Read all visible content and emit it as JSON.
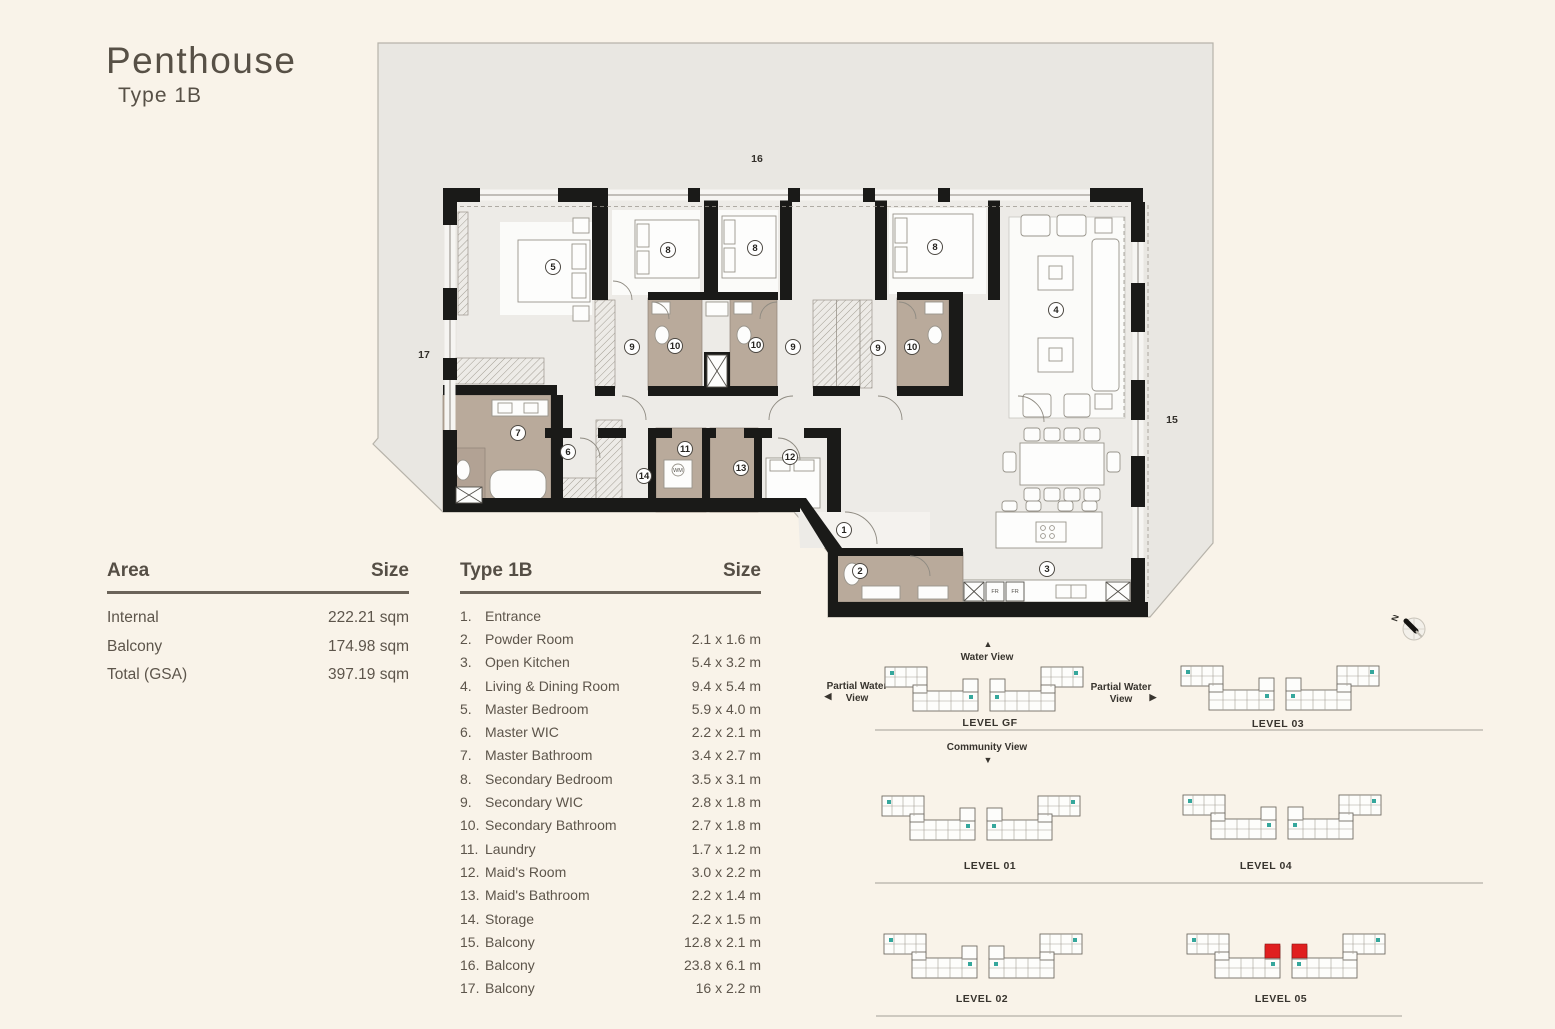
{
  "header": {
    "title": "Penthouse",
    "subtitle": "Type 1B"
  },
  "area_table": {
    "header": {
      "label": "Area",
      "size": "Size"
    },
    "rows": [
      {
        "label": "Internal",
        "value": "222.21 sqm"
      },
      {
        "label": "Balcony",
        "value": "174.98 sqm"
      },
      {
        "label": "Total (GSA)",
        "value": "397.19 sqm"
      }
    ]
  },
  "legend": {
    "header": {
      "label": "Type 1B",
      "size": "Size"
    },
    "rows": [
      {
        "num": "1.",
        "name": "Entrance",
        "size": ""
      },
      {
        "num": "2.",
        "name": "Powder Room",
        "size": "2.1 x 1.6 m"
      },
      {
        "num": "3.",
        "name": "Open Kitchen",
        "size": "5.4 x 3.2 m"
      },
      {
        "num": "4.",
        "name": "Living & Dining Room",
        "size": "9.4 x 5.4 m"
      },
      {
        "num": "5.",
        "name": "Master Bedroom",
        "size": "5.9 x 4.0 m"
      },
      {
        "num": "6.",
        "name": "Master  WIC",
        "size": "2.2 x 2.1 m"
      },
      {
        "num": "7.",
        "name": "Master Bathroom",
        "size": "3.4 x 2.7 m"
      },
      {
        "num": "8.",
        "name": "Secondary Bedroom",
        "size": "3.5 x 3.1 m"
      },
      {
        "num": "9.",
        "name": "Secondary WIC",
        "size": "2.8 x 1.8 m"
      },
      {
        "num": "10.",
        "name": "Secondary Bathroom",
        "size": "2.7 x 1.8 m"
      },
      {
        "num": "11.",
        "name": "Laundry",
        "size": "1.7 x 1.2 m"
      },
      {
        "num": "12.",
        "name": "Maid's Room",
        "size": "3.0 x 2.2 m"
      },
      {
        "num": "13.",
        "name": "Maid's Bathroom",
        "size": "2.2 x 1.4 m"
      },
      {
        "num": "14.",
        "name": "Storage",
        "size": "2.2 x 1.5 m"
      },
      {
        "num": "15.",
        "name": "Balcony",
        "size": "12.8 x 2.1 m"
      },
      {
        "num": "16.",
        "name": "Balcony",
        "size": "23.8 x 6.1 m"
      },
      {
        "num": "17.",
        "name": "Balcony",
        "size": "16 x 2.2 m"
      }
    ]
  },
  "plan": {
    "labels": {
      "l1": "1",
      "l2": "2",
      "l3": "3",
      "l4": "4",
      "l5": "5",
      "l6": "6",
      "l7": "7",
      "l8a": "8",
      "l8b": "8",
      "l8c": "8",
      "l9a": "9",
      "l9b": "9",
      "l9c": "9",
      "l10a": "10",
      "l10b": "10",
      "l10c": "10",
      "l11": "11",
      "l12": "12",
      "l13": "13",
      "l14": "14",
      "l15": "15",
      "l16": "16",
      "l17": "17"
    },
    "appliances": {
      "wm": "WM",
      "fr": "FR"
    }
  },
  "levels": {
    "north": "N",
    "views": {
      "water": "Water View",
      "partial_line1": "Partial Water",
      "partial_line2": "View",
      "community": "Community View"
    },
    "rows": [
      {
        "left": "LEVEL GF",
        "right": "LEVEL 03"
      },
      {
        "left": "LEVEL 01",
        "right": "LEVEL 04"
      },
      {
        "left": "LEVEL 02",
        "right": "LEVEL 05"
      }
    ]
  },
  "icons": {
    "arrow_up": "▲",
    "arrow_down": "▼",
    "arrow_left": "◀",
    "arrow_right": "▶"
  },
  "colors": {
    "highlight": "#e01f1f",
    "teal": "#35a79c"
  }
}
